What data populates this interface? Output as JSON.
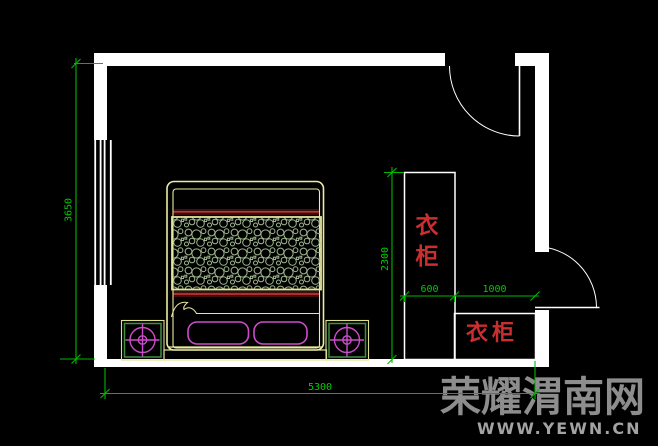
{
  "drawing": {
    "type": "bedroom-floor-plan",
    "labels": {
      "wardrobe_tall": "衣柜",
      "wardrobe_low": "衣柜"
    },
    "dimensions": {
      "room_height": "3650",
      "room_width": "5300",
      "wardrobe_height": "2300",
      "wardrobe_depth": "600",
      "closet_width": "1000"
    },
    "colors": {
      "background": "#000000",
      "wall": "#ffffff",
      "furniture_yellow": "#ededa0",
      "quilt_pattern_green": "#9fb88e",
      "accent_magenta": "#cc4ccc",
      "nightstand_green": "#3f8f3f",
      "dimension_green": "#00b800",
      "bed_line_red": "#cf3a3a",
      "bed_band_maroon": "#420d0d",
      "label_red": "#cb2e2e",
      "watermark_gray": "#8d8d8d"
    }
  },
  "watermark": {
    "site_name": "荣耀渭南网",
    "site_url": "WWW.YEWN.CN"
  }
}
